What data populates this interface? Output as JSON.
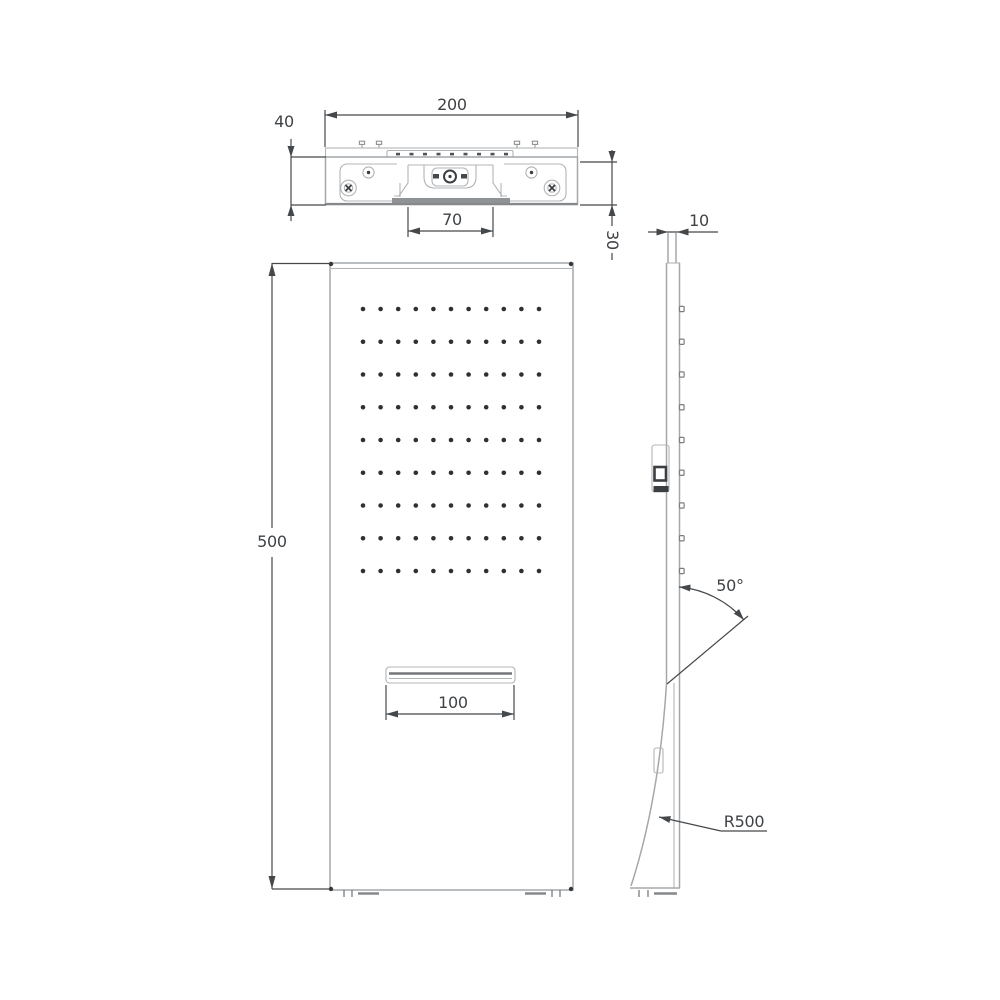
{
  "drawing": {
    "dimensions": {
      "top_width": "200",
      "top_height": "40",
      "outlet_recess_width": "70",
      "mount_depth": "30",
      "panel_height": "500",
      "spout_width": "100",
      "panel_thickness": "10",
      "spray_angle": "50°",
      "bend_radius": "R500"
    },
    "spray_grid": {
      "rows": 9,
      "columns": 11
    },
    "colors": {
      "outline": "#a4a8ab",
      "dimension": "#45484b",
      "holes": "#2e3134"
    }
  }
}
